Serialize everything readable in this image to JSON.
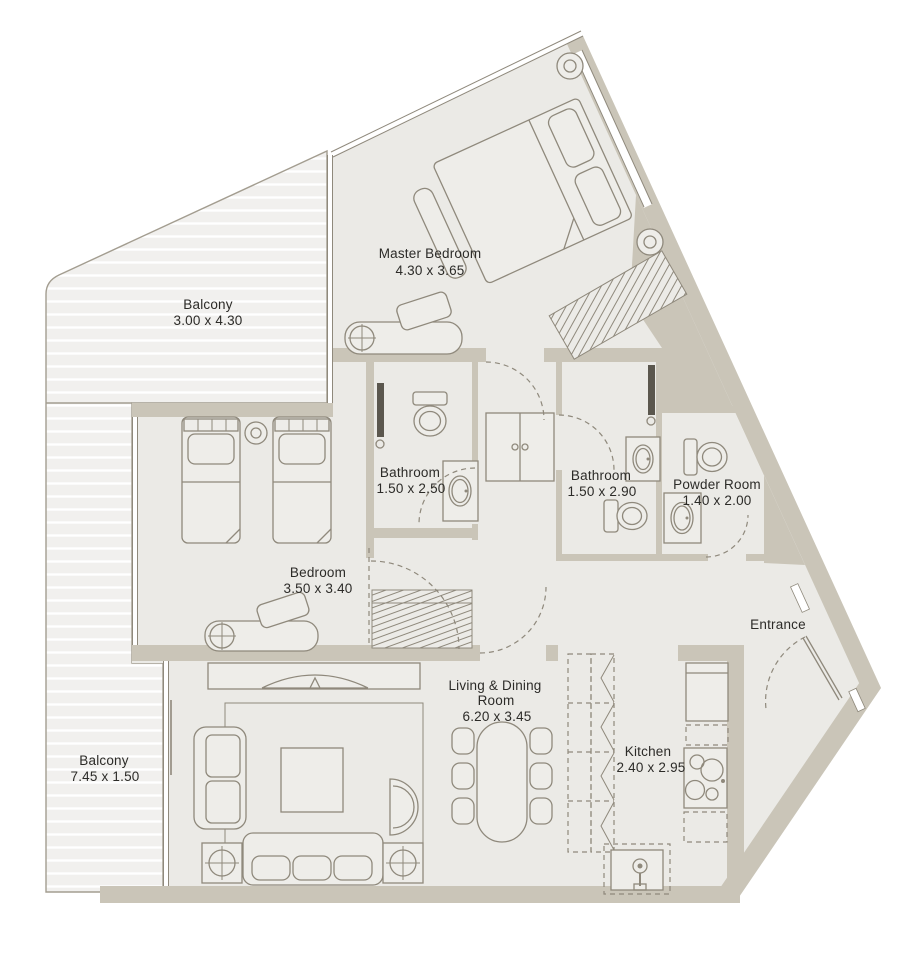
{
  "floorplan": {
    "colors": {
      "wall": "#cac5b8",
      "floor": "#ebeae6",
      "balcony_deck": "#f1f0ee",
      "line": "#8f897c",
      "text": "#2c2b28"
    },
    "rooms": {
      "master_bedroom": {
        "name": "Master Bedroom",
        "dims": "4.30 x 3.65"
      },
      "balcony_top": {
        "name": "Balcony",
        "dims": "3.00 x 4.30"
      },
      "bathroom_1": {
        "name": "Bathroom",
        "dims": "1.50 x 2.50"
      },
      "bathroom_2": {
        "name": "Bathroom",
        "dims": "1.50 x 2.90"
      },
      "powder_room": {
        "name": "Powder Room",
        "dims": "1.40 x 2.00"
      },
      "bedroom": {
        "name": "Bedroom",
        "dims": "3.50 x 3.40"
      },
      "entrance": {
        "name": "Entrance"
      },
      "living_dining": {
        "name_line1": "Living & Dining",
        "name_line2": "Room",
        "dims": "6.20 x 3.45"
      },
      "kitchen": {
        "name": "Kitchen",
        "dims": "2.40 x 2.95"
      },
      "balcony_bottom": {
        "name": "Balcony",
        "dims": "7.45 x 1.50"
      }
    }
  }
}
